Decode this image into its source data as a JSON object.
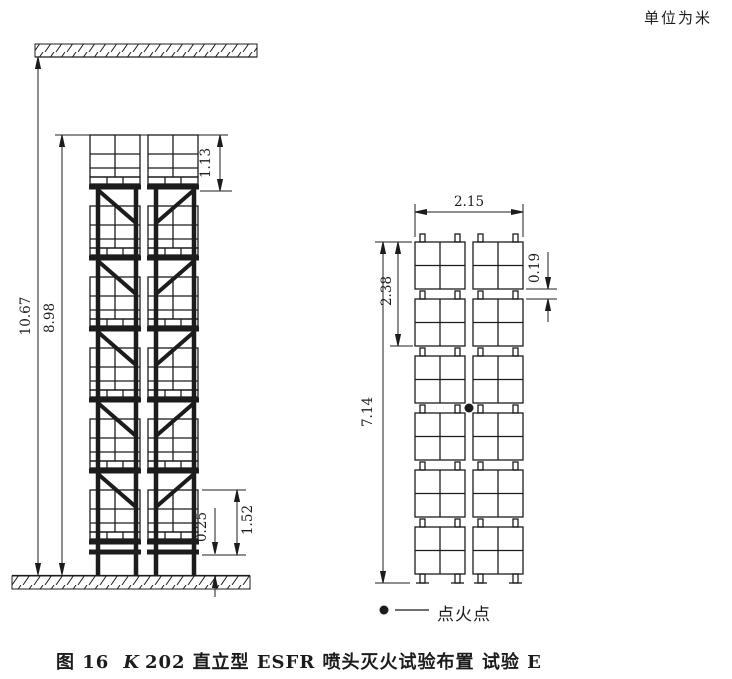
{
  "unit_note": "单位为米",
  "front_elevation": {
    "dim_ceiling_height": "10.67",
    "dim_top_of_storage": "8.98",
    "dim_top_tier_load": "1.13",
    "dim_tier_height": "1.52",
    "dim_floor_clearance": "0.25"
  },
  "side_elevation": {
    "dim_array_width": "2.15",
    "dim_two_tiers": "2.38",
    "dim_pallet_gap": "0.19",
    "dim_stack_height": "7.14"
  },
  "legend": {
    "symbol": "●",
    "label": "点火点"
  },
  "caption": {
    "figure_no": "图 16",
    "code_prefix": "K",
    "code_number": "202",
    "title": "直立型 ESFR 喷头灭火试验布置 试验 E"
  },
  "colors": {
    "line": "#1c1c1c",
    "background": "#ffffff"
  }
}
